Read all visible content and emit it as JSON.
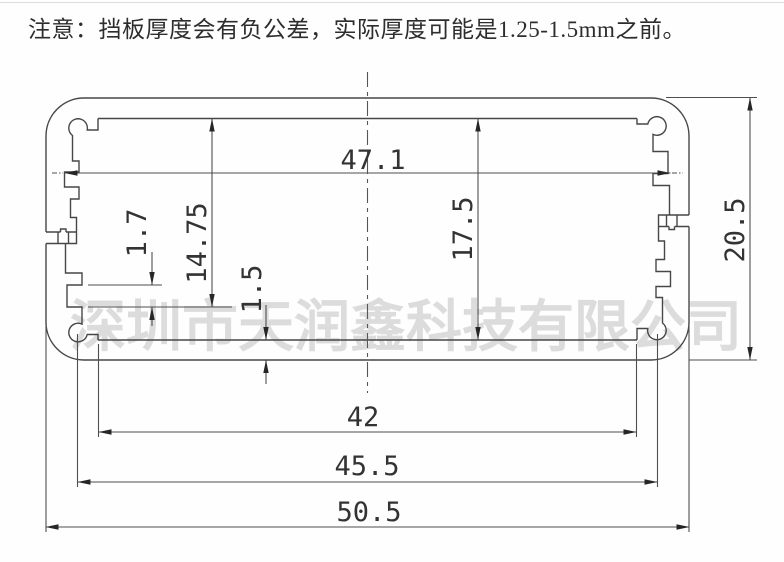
{
  "note": {
    "text": "注意：挡板厚度会有负公差，实际厚度可能是1.25-1.5mm之前。"
  },
  "watermark": {
    "text": "深圳市天润鑫科技有限公司",
    "color": "#c8c8c8"
  },
  "drawing": {
    "type": "aluminum-enclosure-profile-cross-section",
    "line_color": "#474747",
    "dims": {
      "inner_width": "47.1",
      "left_cavity_height": "14.75",
      "pcb_slot_height": "1.7",
      "panel_thickness": "1.5",
      "inner_height": "17.5",
      "overall_height": "20.5",
      "inner_step_width": "42",
      "screw_hole_spacing": "45.5",
      "overall_width": "50.5"
    }
  }
}
